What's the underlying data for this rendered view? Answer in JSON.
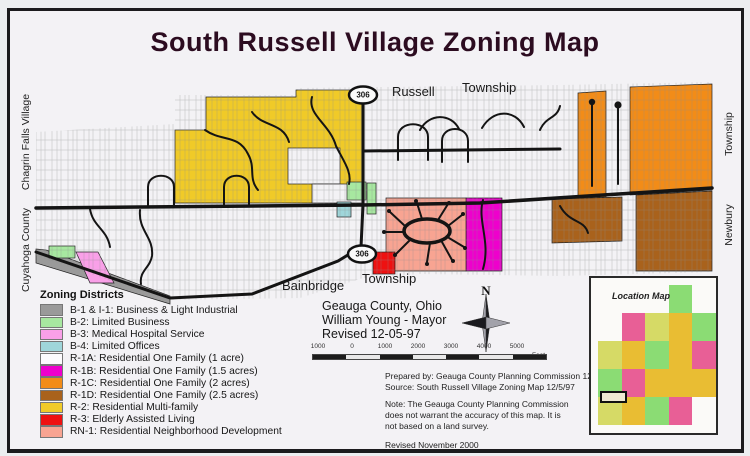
{
  "title": "South Russell Village Zoning Map",
  "map_labels": {
    "russell": "Russell",
    "township_top": "Township",
    "bainbridge": "Bainbridge",
    "township_bottom": "Township",
    "chagrin_falls": "Chagrin Falls Village",
    "cuyahoga_county": "Cuyahoga County",
    "township_right": "Township",
    "newbury": "Newbury",
    "route_306": "306"
  },
  "info": {
    "county": "Geauga County, Ohio",
    "mayor": "William Young - Mayor",
    "revised": "Revised 12-05-97"
  },
  "compass": {
    "north": "N"
  },
  "scale_bar": {
    "labels": [
      "1000",
      "0",
      "1000",
      "2000",
      "3000",
      "4000",
      "5000"
    ],
    "unit": "Feet"
  },
  "legend": {
    "heading": "Zoning Districts",
    "items": [
      {
        "code": "B-1 & I-1",
        "label": "B-1 & I-1: Business & Light Industrial",
        "color": "#9a9a9a"
      },
      {
        "code": "B-2",
        "label": "B-2: Limited Business",
        "color": "#a7e8a0"
      },
      {
        "code": "B-3",
        "label": "B-3: Medical Hospital Service",
        "color": "#f9a0e8"
      },
      {
        "code": "B-4",
        "label": "B-4: Limited Offices",
        "color": "#9fd6da"
      },
      {
        "code": "R-1A",
        "label": "R-1A: Residential One Family (1 acre)",
        "color": "#fcfbfd"
      },
      {
        "code": "R-1B",
        "label": "R-1B: Residential One Family (1.5 acres)",
        "color": "#ee00cc"
      },
      {
        "code": "R-1C",
        "label": "R-1C: Residential One Family (2 acres)",
        "color": "#f28c18"
      },
      {
        "code": "R-1D",
        "label": "R-1D: Residential One Family (2.5 acres)",
        "color": "#a9621c"
      },
      {
        "code": "R-2",
        "label": "R-2: Residential Multi-family",
        "color": "#f0ca28"
      },
      {
        "code": "R-3",
        "label": "R-3: Elderly Assisted Living",
        "color": "#ee1111"
      },
      {
        "code": "RN-1",
        "label": "RN-1: Residential Neighborhood Development",
        "color": "#f8a492"
      }
    ]
  },
  "credits": {
    "prepared": "Prepared by: Geauga County Planning Commission 12/8/99",
    "source": "Source: South Russell Village Zoning Map 12/5/97",
    "note_lines": [
      "Note: The Geauga County Planning Commission",
      "does not warrant the accuracy of this map.  It is",
      "not based on a land survey."
    ],
    "revised": "Revised November 2000"
  },
  "location_map": {
    "title": "Location Map",
    "grid": [
      [
        null,
        null,
        null,
        "#8bdc74",
        null
      ],
      [
        null,
        "#e85f96",
        "#d6da66",
        "#e9bd33",
        "#8bdc74"
      ],
      [
        "#d6da66",
        "#e9bd33",
        "#8bdc74",
        "#e9bd33",
        "#e85f96"
      ],
      [
        "#8bdc74",
        "#e85f96",
        "#e9bd33",
        "#e9bd33",
        "#e9bd33"
      ],
      [
        "#d6da66",
        "#e9bd33",
        "#8bdc74",
        "#e85f96",
        null
      ]
    ]
  }
}
